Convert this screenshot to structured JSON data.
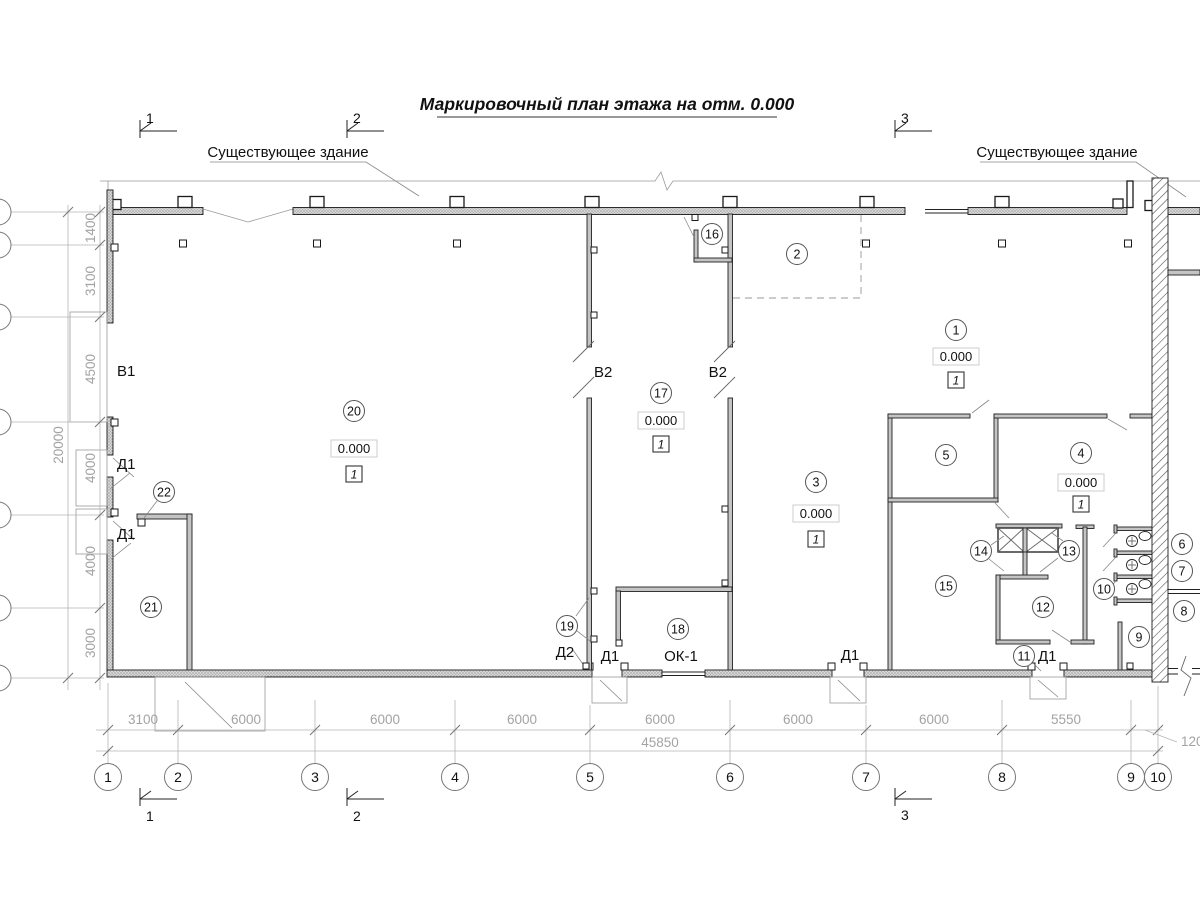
{
  "title": "Маркировочный план этажа на отм. 0.000",
  "colors": {
    "ink": "#1a1a1a",
    "dim_gray": "#a3a3a3",
    "paper": "#ffffff"
  },
  "labels": {
    "existing_left": "Существующее здание",
    "existing_right": "Существующее здание"
  },
  "sections": {
    "s1": "1",
    "s2": "2",
    "s3": "3"
  },
  "grid": {
    "cols": [
      "1",
      "2",
      "3",
      "4",
      "5",
      "6",
      "7",
      "8",
      "9",
      "10"
    ],
    "col_dims": [
      "3100",
      "6000",
      "6000",
      "6000",
      "6000",
      "6000",
      "6000",
      "5550"
    ],
    "col_total": "45850",
    "offset_dim": "120",
    "row_dims": [
      "1400",
      "3100",
      "4500",
      "4000",
      "4000",
      "3000"
    ],
    "row_total": "20000"
  },
  "marks": {
    "v1": "В1",
    "v2a": "В2",
    "v2b": "В2",
    "d1a": "Д1",
    "d1b": "Д1",
    "d1c": "Д1",
    "d1d": "Д1",
    "d1e": "Д1",
    "d2": "Д2",
    "ok1": "ОК-1"
  },
  "elev": {
    "value": "0.000",
    "idx": "1"
  },
  "rooms": {
    "r1": "1",
    "r2": "2",
    "r3": "3",
    "r4": "4",
    "r5": "5",
    "r6": "6",
    "r7": "7",
    "r8": "8",
    "r9": "9",
    "r10": "10",
    "r11": "11",
    "r12": "12",
    "r13": "13",
    "r14": "14",
    "r15": "15",
    "r16": "16",
    "r17": "17",
    "r18": "18",
    "r19": "19",
    "r20": "20",
    "r21": "21",
    "r22": "22"
  }
}
